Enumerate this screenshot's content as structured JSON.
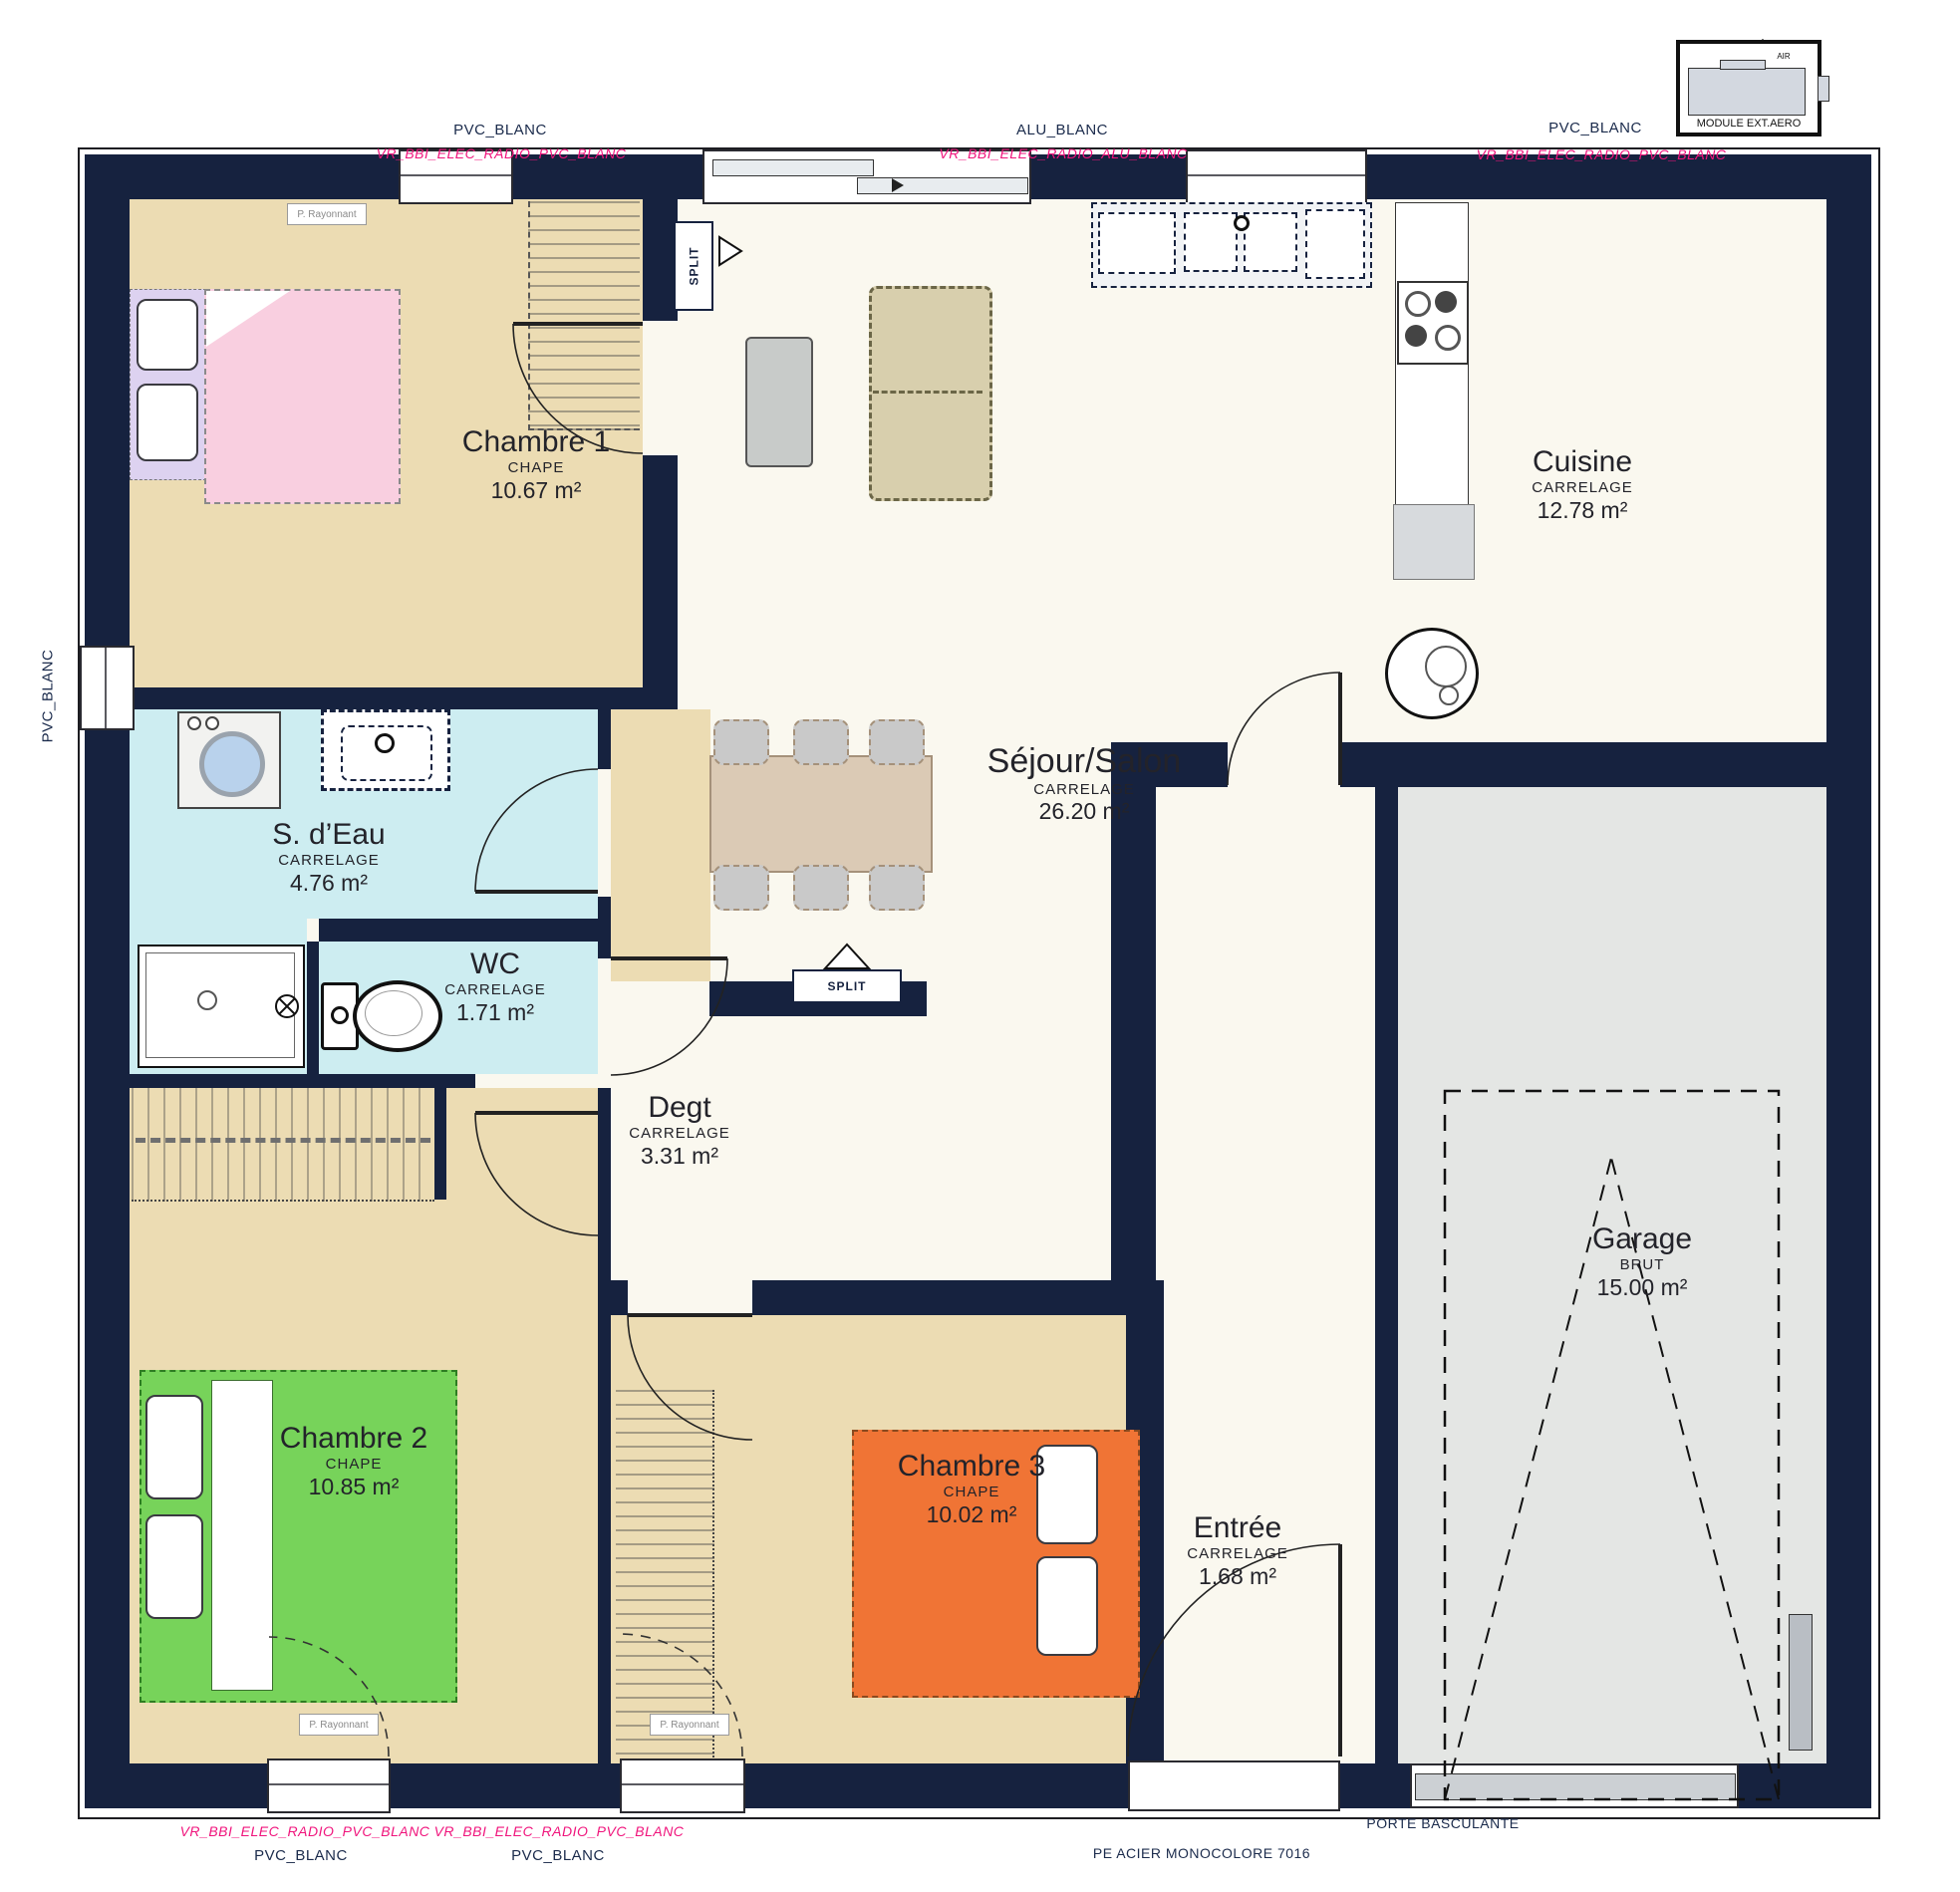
{
  "plan_title": "Plan maison plain-pied 3 chambres avec garage",
  "colors": {
    "wall": "#16223f",
    "bedroom_beige": "#ecdcb3",
    "living_cream": "#faf8ef",
    "water_blue": "#cdedf1",
    "garage_gray": "#e4e6e4",
    "bed1_pink": "#f9cfe0",
    "bed2_green": "#77d35a",
    "bed3_orange": "#f07435",
    "wardrobe_lavender": "#ddd2f0",
    "annotation_pink": "#f0147c",
    "annotation_navy": "#1b2b4c"
  },
  "rooms": {
    "chambre1": {
      "name": "Chambre 1",
      "material": "CHAPE",
      "area": "10.67 m²"
    },
    "cuisine": {
      "name": "Cuisine",
      "material": "CARRELAGE",
      "area": "12.78 m²"
    },
    "sejour": {
      "name": "Séjour/Salon",
      "material": "CARRELAGE",
      "area": "26.20 m²"
    },
    "sdeau": {
      "name": "S. d’Eau",
      "material": "CARRELAGE",
      "area": "4.76 m²"
    },
    "wc": {
      "name": "WC",
      "material": "CARRELAGE",
      "area": "1.71 m²"
    },
    "degt": {
      "name": "Degt",
      "material": "CARRELAGE",
      "area": "3.31 m²"
    },
    "chambre2": {
      "name": "Chambre 2",
      "material": "CHAPE",
      "area": "10.85 m²"
    },
    "chambre3": {
      "name": "Chambre 3",
      "material": "CHAPE",
      "area": "10.02 m²"
    },
    "entree": {
      "name": "Entrée",
      "material": "CARRELAGE",
      "area": "1.68 m²"
    },
    "garage": {
      "name": "Garage",
      "material": "BRUT",
      "area": "15.00 m²"
    }
  },
  "joinery_labels": {
    "top_left_window": {
      "product": "PVC_BLANC",
      "code": "VR_BBI_ELEC_RADIO_PVC_BLANC"
    },
    "top_bay_window": {
      "product": "ALU_BLANC",
      "code": "VR_BBI_ELEC_RADIO_ALU_BLANC"
    },
    "top_right_window": {
      "product": "PVC_BLANC",
      "code": "VR_BBI_ELEC_RADIO_PVC_BLANC"
    },
    "left_window": {
      "product": "PVC_BLANC"
    },
    "bottom_left_window": {
      "product": "PVC_BLANC",
      "code": "VR_BBI_ELEC_RADIO_PVC_BLANC"
    },
    "bottom_middle_window": {
      "product": "PVC_BLANC",
      "code": "VR_BBI_ELEC_RADIO_PVC_BLANC"
    },
    "entry_door": "PE ACIER MONOCOLORE 7016",
    "garage_door": "PORTE BASCULANTE"
  },
  "equipment_labels": {
    "aero_module": "MODULE EXT.AERO",
    "air": "AIR",
    "split": "SPLIT",
    "radiant_panel": "P. Rayonnant"
  }
}
